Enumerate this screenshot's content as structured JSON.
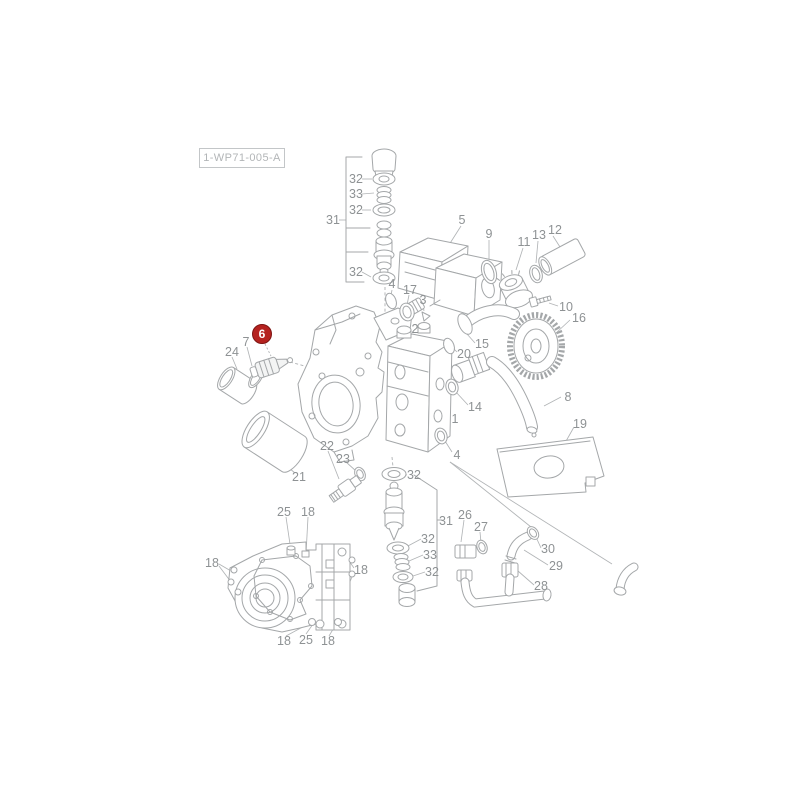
{
  "drawing_ref": {
    "label": "1-WP71-005-A"
  },
  "highlight": {
    "number": "6",
    "x": 262,
    "y": 334,
    "color": "#b5221f",
    "border": "#7e1513"
  },
  "callouts": [
    {
      "text": "32",
      "x": 356,
      "y": 179
    },
    {
      "text": "33",
      "x": 356,
      "y": 194
    },
    {
      "text": "32",
      "x": 356,
      "y": 210
    },
    {
      "text": "31",
      "x": 333,
      "y": 220
    },
    {
      "text": "32",
      "x": 356,
      "y": 272
    },
    {
      "text": "5",
      "x": 462,
      "y": 220
    },
    {
      "text": "9",
      "x": 489,
      "y": 234
    },
    {
      "text": "11",
      "x": 524,
      "y": 242
    },
    {
      "text": "13",
      "x": 539,
      "y": 235
    },
    {
      "text": "12",
      "x": 555,
      "y": 230
    },
    {
      "text": "10",
      "x": 566,
      "y": 307
    },
    {
      "text": "16",
      "x": 579,
      "y": 318
    },
    {
      "text": "4",
      "x": 392,
      "y": 284
    },
    {
      "text": "17",
      "x": 410,
      "y": 290
    },
    {
      "text": "3",
      "x": 423,
      "y": 300
    },
    {
      "text": "2",
      "x": 415,
      "y": 329
    },
    {
      "text": "20",
      "x": 464,
      "y": 354
    },
    {
      "text": "15",
      "x": 482,
      "y": 344
    },
    {
      "text": "14",
      "x": 475,
      "y": 407
    },
    {
      "text": "1",
      "x": 455,
      "y": 419
    },
    {
      "text": "4",
      "x": 457,
      "y": 455
    },
    {
      "text": "8",
      "x": 568,
      "y": 397
    },
    {
      "text": "19",
      "x": 580,
      "y": 424
    },
    {
      "text": "24",
      "x": 232,
      "y": 352
    },
    {
      "text": "7",
      "x": 246,
      "y": 342
    },
    {
      "text": "21",
      "x": 299,
      "y": 477
    },
    {
      "text": "22",
      "x": 327,
      "y": 446
    },
    {
      "text": "23",
      "x": 343,
      "y": 459
    },
    {
      "text": "32",
      "x": 414,
      "y": 475
    },
    {
      "text": "31",
      "x": 446,
      "y": 521
    },
    {
      "text": "32",
      "x": 428,
      "y": 539
    },
    {
      "text": "33",
      "x": 430,
      "y": 555
    },
    {
      "text": "32",
      "x": 432,
      "y": 572
    },
    {
      "text": "26",
      "x": 465,
      "y": 515
    },
    {
      "text": "27",
      "x": 481,
      "y": 527
    },
    {
      "text": "30",
      "x": 548,
      "y": 549
    },
    {
      "text": "29",
      "x": 556,
      "y": 566
    },
    {
      "text": "28",
      "x": 541,
      "y": 586
    },
    {
      "text": "25",
      "x": 284,
      "y": 512
    },
    {
      "text": "18",
      "x": 308,
      "y": 512
    },
    {
      "text": "18",
      "x": 212,
      "y": 563
    },
    {
      "text": "18",
      "x": 361,
      "y": 570
    },
    {
      "text": "18",
      "x": 284,
      "y": 641
    },
    {
      "text": "25",
      "x": 306,
      "y": 640
    },
    {
      "text": "18",
      "x": 328,
      "y": 641
    }
  ]
}
